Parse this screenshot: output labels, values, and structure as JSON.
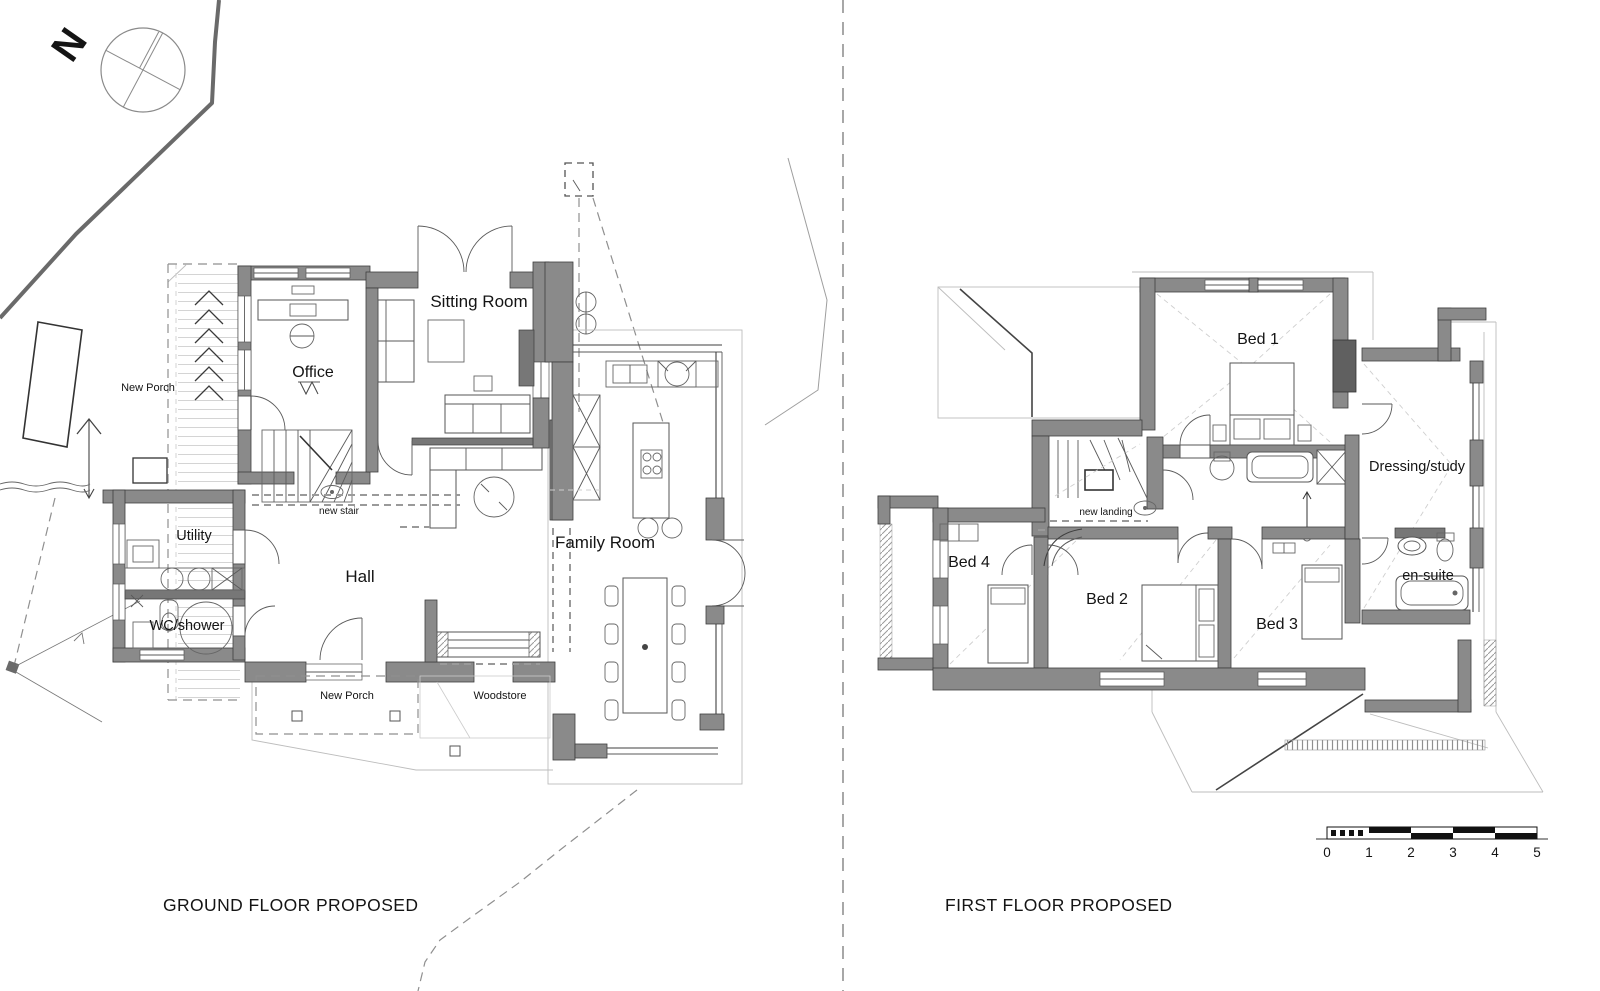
{
  "page": {
    "background": "#ffffff",
    "type": "architectural-plan-sheet"
  },
  "compass": {
    "north_label": "N"
  },
  "ground_floor": {
    "title": "GROUND FLOOR PROPOSED",
    "labels": {
      "new_porch_left": "New Porch",
      "office": "Office",
      "sitting_room": "Sitting Room",
      "utility": "Utility",
      "hall": "Hall",
      "wc_shower": "WC/shower",
      "new_stair": "new stair",
      "family_room": "Family Room",
      "new_porch_bottom": "New Porch",
      "woodstore": "Woodstore"
    }
  },
  "first_floor": {
    "title": "FIRST FLOOR PROPOSED",
    "labels": {
      "bed1": "Bed 1",
      "bed2": "Bed 2",
      "bed3": "Bed 3",
      "bed4": "Bed 4",
      "dressing_study": "Dressing/study",
      "en_suite": "en-suite",
      "new_landing": "new landing"
    }
  },
  "scale_bar": {
    "tick_labels": [
      "0",
      "1",
      "2",
      "3",
      "4",
      "5"
    ]
  },
  "colors": {
    "wall": "#8a8a8a",
    "wall_dark": "#606060",
    "outline": "#3e3e3e",
    "roof_line": "#bdbdbd",
    "dashed": "#8f8f8f",
    "text": "#141414"
  }
}
